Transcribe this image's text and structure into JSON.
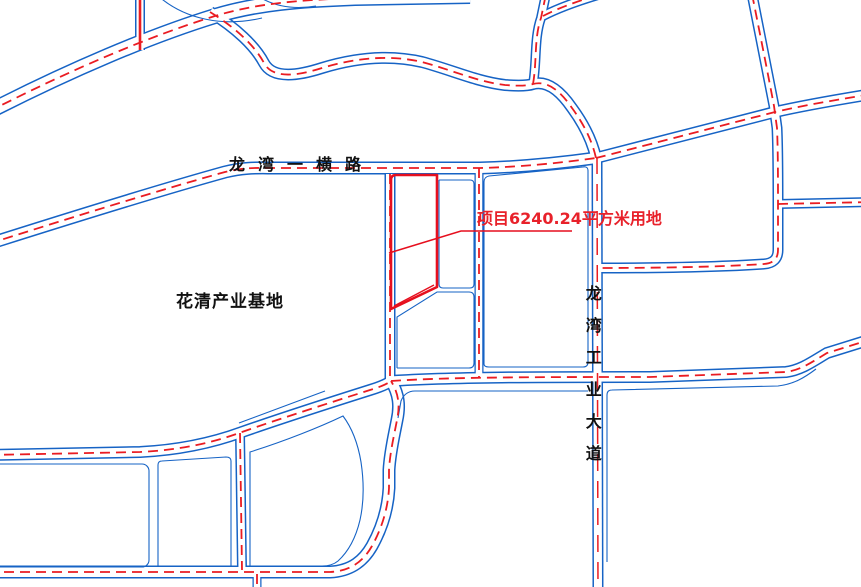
{
  "map": {
    "labels": {
      "road_top": "龙湾一横路",
      "area": "花清产业基地",
      "road_vertical": "龙湾工业大道",
      "project": "项目6240.24平方米用地"
    },
    "colors": {
      "road_edge": "#1663c5",
      "centerline": "#ea1c22",
      "project_outline": "#e60f1e",
      "label_text": "#e8212a",
      "road_name_text": "#111111"
    }
  }
}
